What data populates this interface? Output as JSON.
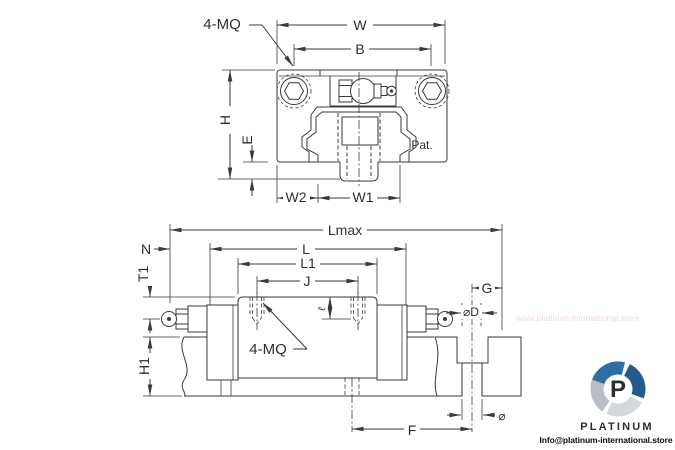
{
  "drawing_type": "linear-guideway-carriage-technical-drawing",
  "top_view": {
    "screw_note": "4-MQ",
    "patent_note": "Pat.",
    "dims": {
      "w": "W",
      "b": "B",
      "h": "H",
      "e": "E",
      "w2": "W2",
      "w1": "W1"
    }
  },
  "side_view": {
    "screw_note": "4-MQ",
    "dims": {
      "lmax": "Lmax",
      "l": "L",
      "l1": "L1",
      "j": "J",
      "n": "N",
      "t1": "T1",
      "h1": "H1",
      "g": "G",
      "d": "⌀D",
      "depth": "ℓ",
      "f": "F",
      "dia": "⌀"
    }
  },
  "watermark": {
    "url": "www.platinum-international.store",
    "brand": "PLATINUM",
    "monogram": "P",
    "contact": "Info@platinum-international.store",
    "brand_color": "#2a6da8",
    "swirl_blue_dark": "#245a8c",
    "swirl_gray": "#b9bec4",
    "swirl_gray_light": "#d6d9dc"
  }
}
